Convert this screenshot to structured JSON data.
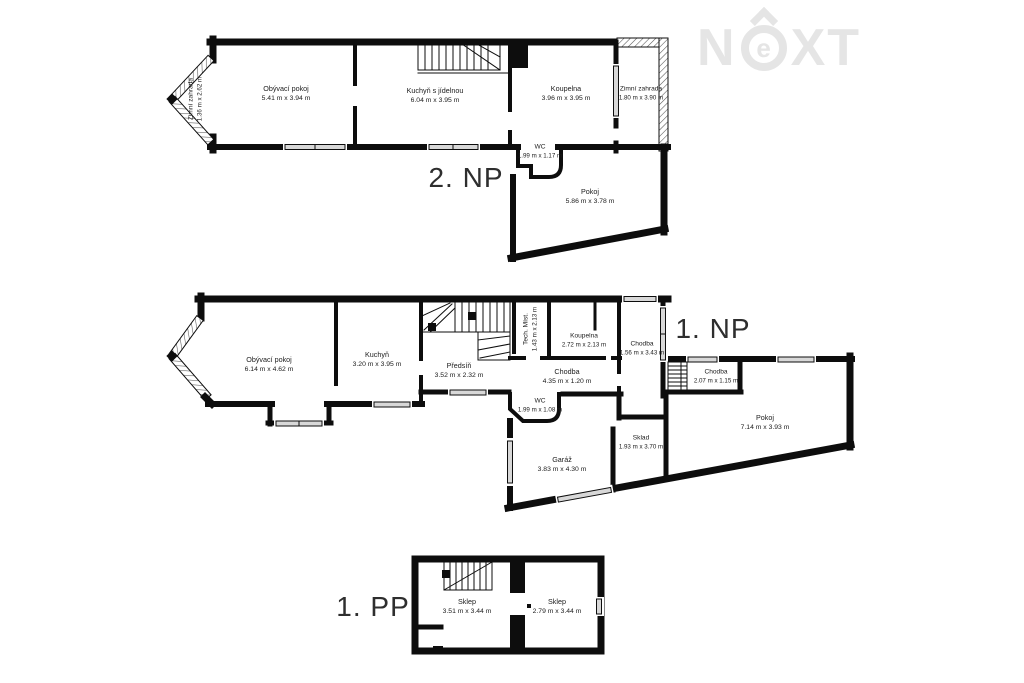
{
  "brand": {
    "text": "NEXT",
    "part_n": "N",
    "part_e": "e",
    "part_xt": "XT"
  },
  "colors": {
    "wall": "#0d0d0d",
    "logo": "#e5e5e5",
    "window_fill": "#d8d8d8"
  },
  "floors": [
    {
      "id": "2np",
      "label": "2. NP",
      "rooms": [
        {
          "name": "Zimní zahrada",
          "dims": "1.36 m x 2.62 m"
        },
        {
          "name": "Obývací pokoj",
          "dims": "5.41 m x 3.94 m"
        },
        {
          "name": "Kuchyň s jídelnou",
          "dims": "6.04 m x 3.95 m"
        },
        {
          "name": "Koupelna",
          "dims": "3.96 m x 3.95 m"
        },
        {
          "name": "Zimní zahrada",
          "dims": "1.80 m x 3.90 m"
        },
        {
          "name": "WC",
          "dims": "1.99 m x 1.17 m"
        },
        {
          "name": "Pokoj",
          "dims": "5.86 m x 3.78 m"
        }
      ]
    },
    {
      "id": "1np",
      "label": "1. NP",
      "rooms": [
        {
          "name": "Obývací pokoj",
          "dims": "6.14 m x 4.62 m"
        },
        {
          "name": "Kuchyň",
          "dims": "3.20 m x 3.95 m"
        },
        {
          "name": "Předsíň",
          "dims": "3.52 m x 2.32 m"
        },
        {
          "name": "Tech. Míst.",
          "dims": "1.43 m x 2.13 m"
        },
        {
          "name": "Koupelna",
          "dims": "2.72 m x 2.13 m"
        },
        {
          "name": "Chodba",
          "dims": "1.56 m x 3.43 m"
        },
        {
          "name": "Chodba",
          "dims": "4.35 m x 1.20 m"
        },
        {
          "name": "Chodba",
          "dims": "2.07 m x 1.15 m"
        },
        {
          "name": "WC",
          "dims": "1.99 m x 1.08 m"
        },
        {
          "name": "Garáž",
          "dims": "3.83 m x 4.30 m"
        },
        {
          "name": "Sklad",
          "dims": "1.93 m x 3.70 m"
        },
        {
          "name": "Pokoj",
          "dims": "7.14 m x 3.93 m"
        }
      ]
    },
    {
      "id": "1pp",
      "label": "1. PP",
      "rooms": [
        {
          "name": "Sklep",
          "dims": "3.51 m x 3.44 m"
        },
        {
          "name": "Sklep",
          "dims": "2.79 m x 3.44 m"
        }
      ]
    }
  ]
}
